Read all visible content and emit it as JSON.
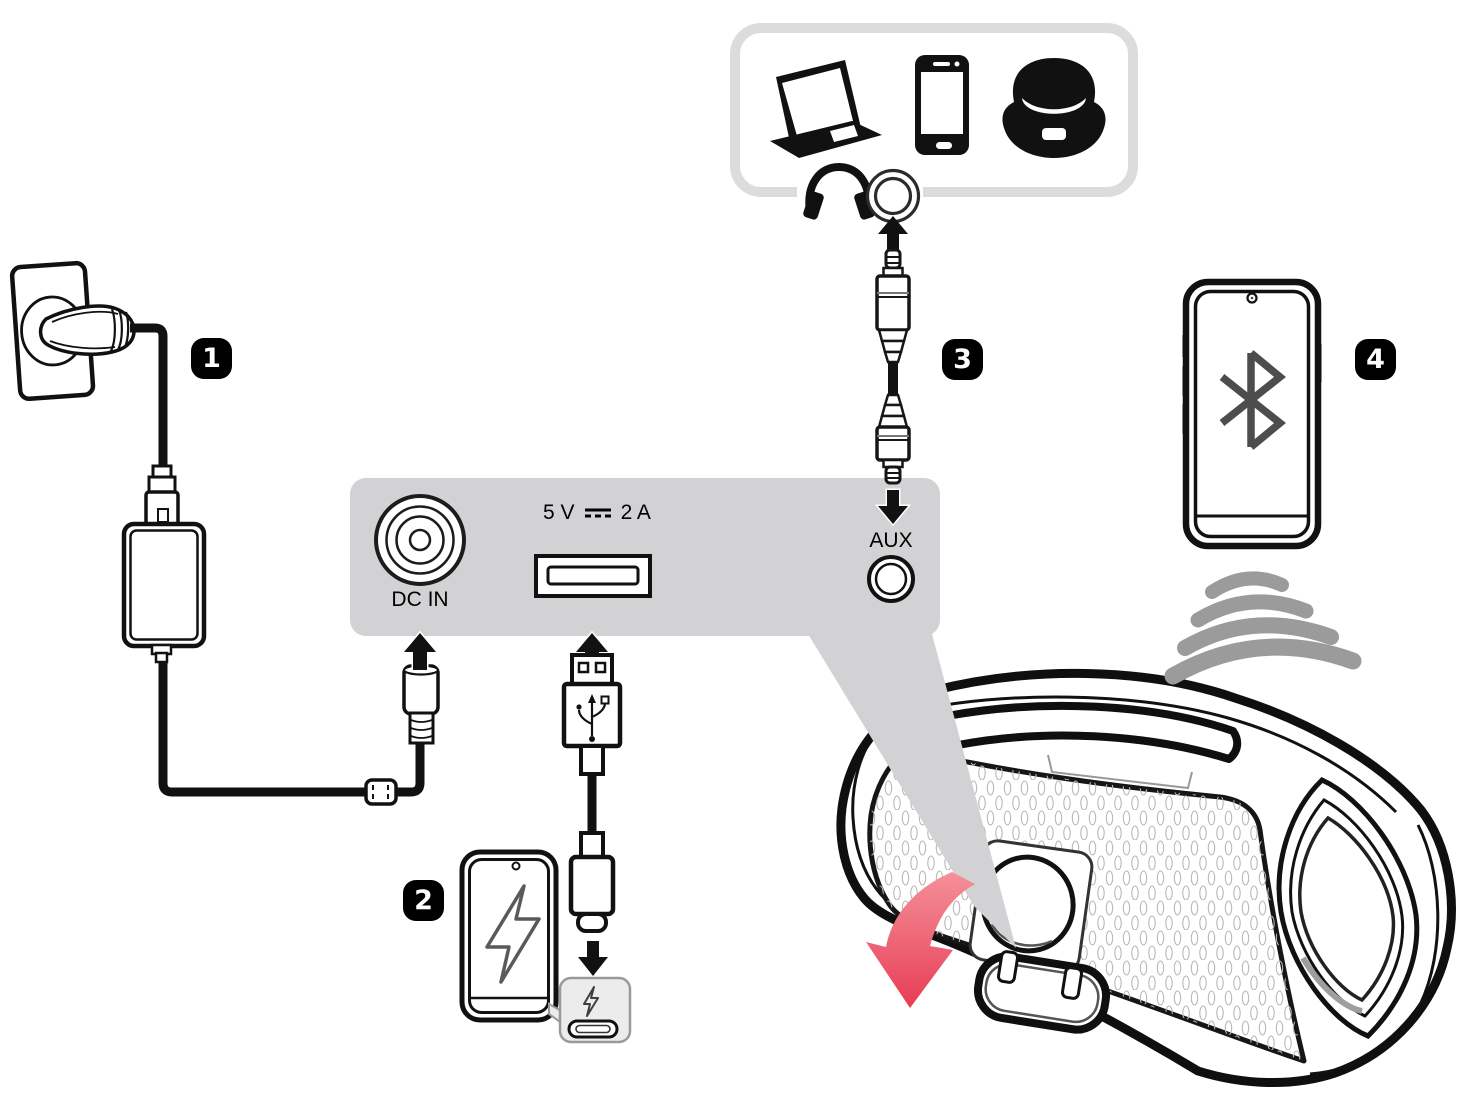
{
  "diagram": {
    "steps": [
      {
        "number": "1",
        "name": "wall-power-connection"
      },
      {
        "number": "2",
        "name": "usb-charge-out"
      },
      {
        "number": "3",
        "name": "aux-input"
      },
      {
        "number": "4",
        "name": "bluetooth-pairing"
      }
    ],
    "panel": {
      "dc_in_label": "DC IN",
      "usb_rating_prefix": "5 V",
      "usb_rating_suffix": "2 A",
      "aux_label": "AUX"
    },
    "icons": [
      "laptop-icon",
      "smartphone-icon",
      "audio-device-icon",
      "headphones-icon",
      "aux-jack-icon",
      "aux-plug-icon",
      "dc-symbol-icon",
      "usb-a-plug-icon",
      "usb-c-plug-icon",
      "lightning-icon",
      "bluetooth-icon",
      "sound-waves-icon",
      "power-plug-icon",
      "power-adapter-icon",
      "dc-plug-icon",
      "open-cover-arrow-icon",
      "speaker-illustration"
    ],
    "colors": {
      "outline_black": "#111111",
      "panel_gray": "#d2d2d4",
      "box_border_gray": "#dcdcdc",
      "callout_gray": "#ececec",
      "wave_gray": "#9b9b9b",
      "bluetooth_gray": "#4d4d4d",
      "red_arrow": "#e73a53",
      "red_arrow_light": "#f5939b"
    }
  }
}
